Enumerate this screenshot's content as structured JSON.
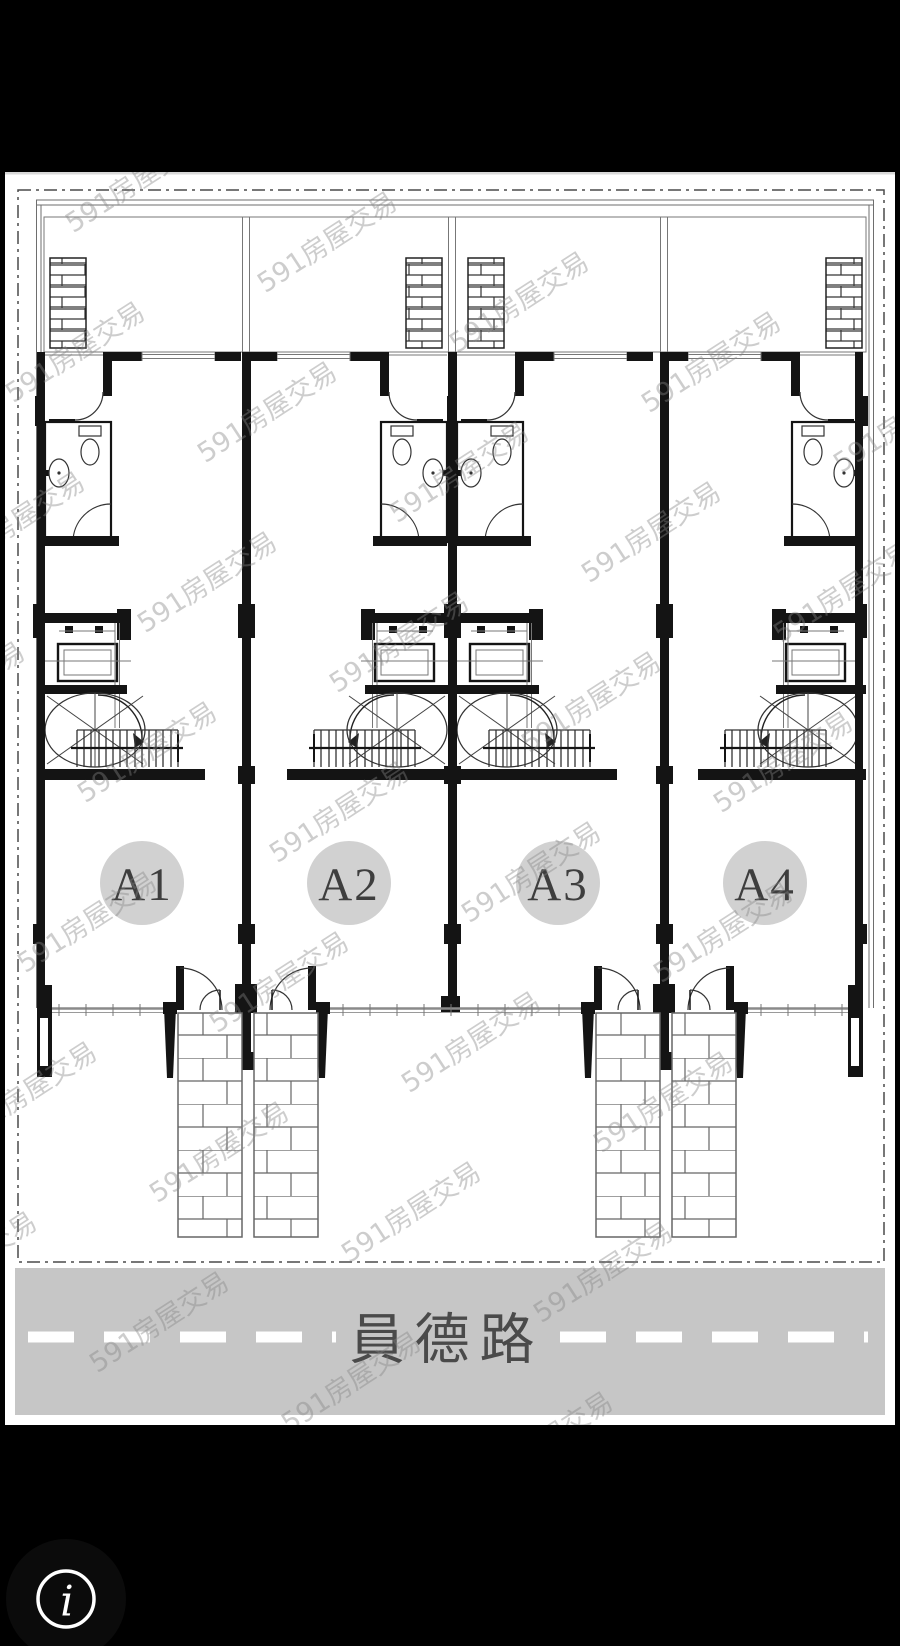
{
  "image_viewer": {
    "background": "#000000"
  },
  "floor_plan": {
    "units": [
      {
        "label": "A1"
      },
      {
        "label": "A2"
      },
      {
        "label": "A3"
      },
      {
        "label": "A4"
      }
    ],
    "road_label": "員德路",
    "watermark_text": "591房屋交易"
  },
  "info_button": {
    "glyph": "i"
  },
  "colors": {
    "bg": "#000000",
    "sheet": "#ffffff",
    "wall": "#141414",
    "thin": "#777777",
    "road": "#c6c6c6",
    "roadline": "#ffffff",
    "roadtext": "#4a4a4a",
    "circle": "#d1d1d1",
    "circletext": "#3e3e3e",
    "wm": "#858585"
  }
}
